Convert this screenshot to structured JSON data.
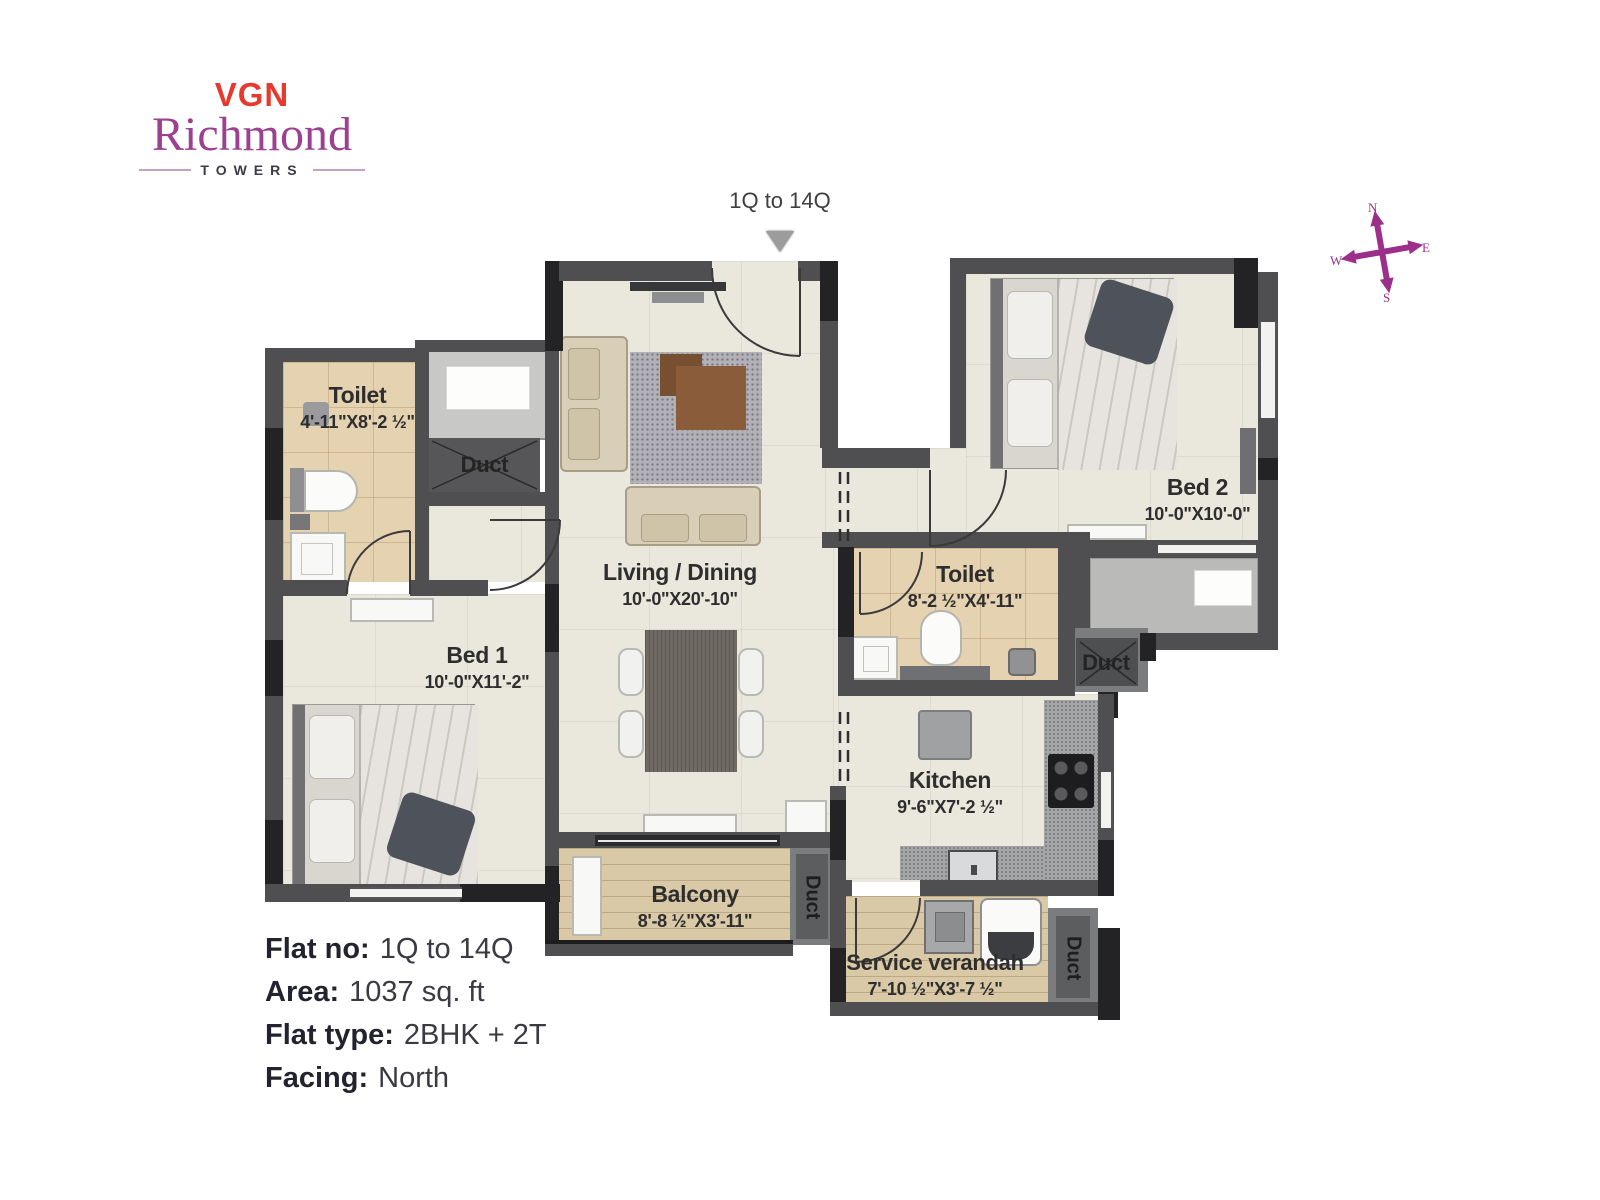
{
  "logo": {
    "brand": "VGN",
    "name": "Richmond",
    "sub": "TOWERS"
  },
  "entrance_marker": {
    "label": "1Q to 14Q"
  },
  "compass": {
    "n": "N",
    "e": "E",
    "s": "S",
    "w": "W"
  },
  "rooms": {
    "toilet1": {
      "name": "Toilet",
      "dims": "4'-11\"X8'-2 ½\""
    },
    "bed1": {
      "name": "Bed 1",
      "dims": "10'-0\"X11'-2\""
    },
    "living": {
      "name": "Living / Dining",
      "dims": "10'-0\"X20'-10\""
    },
    "bed2": {
      "name": "Bed 2",
      "dims": "10'-0\"X10'-0\""
    },
    "toilet2": {
      "name": "Toilet",
      "dims": "8'-2 ½\"X4'-11\""
    },
    "kitchen": {
      "name": "Kitchen",
      "dims": "9'-6\"X7'-2 ½\""
    },
    "balcony": {
      "name": "Balcony",
      "dims": "8'-8 ½\"X3'-11\""
    },
    "service": {
      "name": "Service verandah",
      "dims": "7'-10 ½\"X3'-7 ½\""
    },
    "duct1": {
      "name": "Duct"
    },
    "duct2": {
      "name": "Duct"
    },
    "duct3": {
      "name": "Duct"
    },
    "duct4": {
      "name": "Duct"
    }
  },
  "info": {
    "rows": [
      {
        "label": "Flat no:",
        "value": "1Q to 14Q"
      },
      {
        "label": "Area:",
        "value": "1037 sq. ft"
      },
      {
        "label": "Flat type:",
        "value": "2BHK + 2T"
      },
      {
        "label": "Facing:",
        "value": "North"
      }
    ]
  },
  "colors": {
    "brand_red": "#e8392f",
    "brand_purple": "#9c4191",
    "compass_purple": "#9b2f8a",
    "wall_gray": "#4f4f52",
    "wall_black": "#232325",
    "floor_cream": "#eae7dd",
    "floor_tile": "#e5d2b1",
    "floor_wood": "#d9c9a7"
  }
}
